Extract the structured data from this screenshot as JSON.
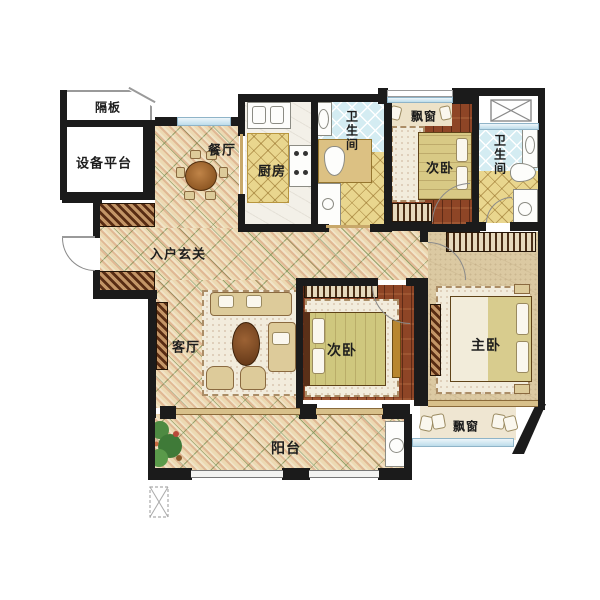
{
  "floorplan": {
    "rooms": {
      "partition": {
        "label": "隔板"
      },
      "equipment_platform": {
        "label": "设备平台"
      },
      "dining": {
        "label": "餐厅"
      },
      "kitchen": {
        "label": "厨房"
      },
      "bathroom_center": {
        "label": "卫生间"
      },
      "bay_window_top": {
        "label": "飘窗"
      },
      "bedroom_top": {
        "label": "次卧"
      },
      "bathroom_right": {
        "label": "卫生间"
      },
      "entry_foyer": {
        "label": "入户玄关"
      },
      "living_room": {
        "label": "客厅"
      },
      "bedroom_middle": {
        "label": "次卧"
      },
      "master_bedroom": {
        "label": "主卧"
      },
      "bay_window_master": {
        "label": "飘窗"
      },
      "balcony": {
        "label": "阳台"
      }
    },
    "colors": {
      "wall": "#1b1b1b",
      "tile_floor": "#ecd9b2",
      "wood_floor": "#8e4526",
      "master_floor": "#dbc9a2",
      "blue_tile": "#d4ecf2",
      "yellow_tile": "#e9d68e",
      "window_glass": "#bcdcea",
      "label_text": "#1d1d1d"
    }
  }
}
